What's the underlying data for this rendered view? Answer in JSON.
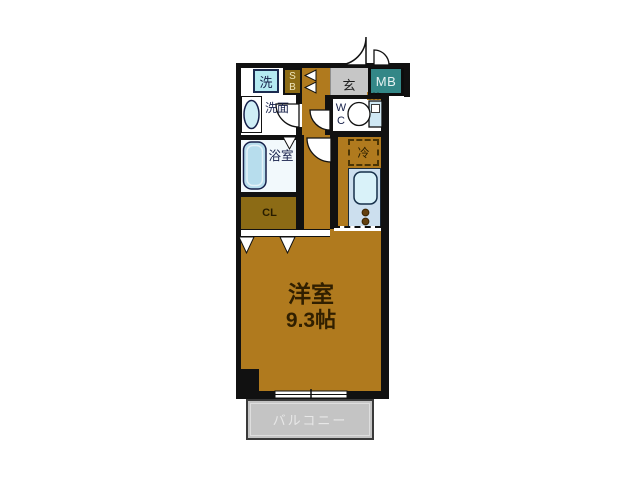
{
  "floorplan": {
    "type": "apartment-floor-plan",
    "main_room": {
      "name": "洋室",
      "area": "9.3帖"
    },
    "balcony": {
      "label": "バルコニー"
    },
    "entrance": {
      "label": "玄"
    },
    "meter_box": {
      "label": "MB"
    },
    "shoe_box": {
      "line1": "S",
      "line2": "B"
    },
    "washer": {
      "label": "洗"
    },
    "washroom": {
      "label": "洗面"
    },
    "bathroom": {
      "label": "浴室"
    },
    "toilet": {
      "line1": "W",
      "line2": "C"
    },
    "closet": {
      "label": "CL"
    },
    "refrigerator": {
      "label": "冷"
    },
    "colors": {
      "floor": "#b07a1e",
      "storage": "#8c6b15",
      "wall": "#111111",
      "meter_box": "#338787",
      "entrance_floor": "#c6c6c6",
      "balcony": "#c4c4c4",
      "water_fixture": "#cfe8f4",
      "washer_box": "#b4eaf2",
      "kitchen_counter": "#ccdfee"
    }
  }
}
